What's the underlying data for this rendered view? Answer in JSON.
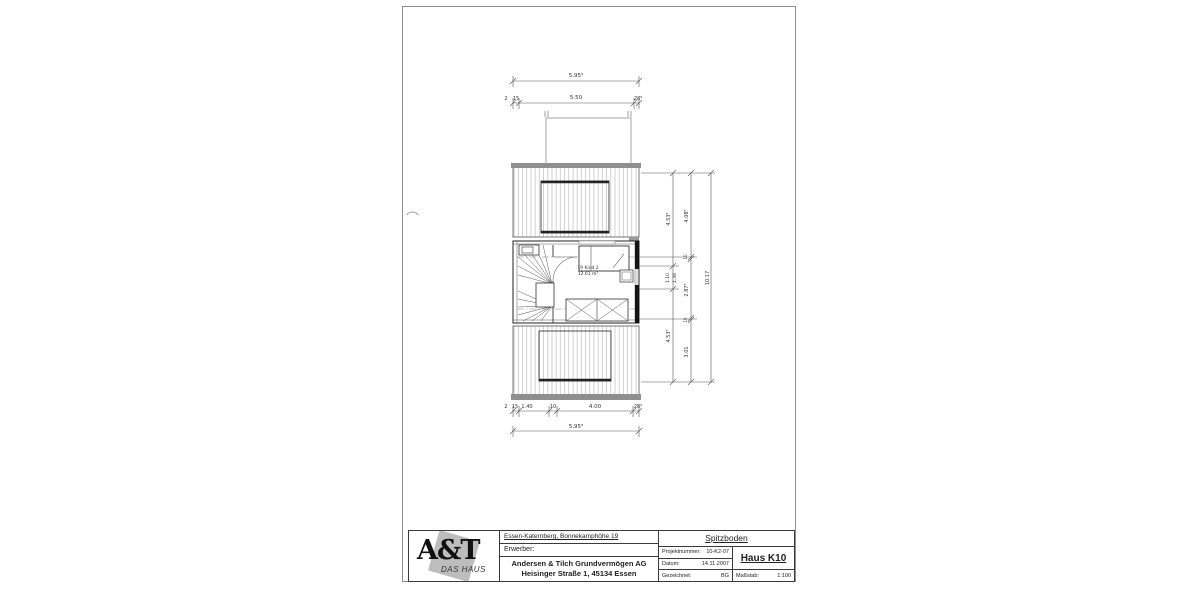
{
  "drawing": {
    "dims_top": {
      "total": "5.95⁵",
      "seg_a": "2",
      "seg_b": "15",
      "seg_mid": "5.50",
      "seg_right": "28⁵"
    },
    "dims_bottom": {
      "segs": [
        "2",
        "15",
        "1.40",
        "10",
        "4.00",
        "28⁵"
      ],
      "total": "5.95⁵"
    },
    "dims_right": {
      "inner_top": "4.53⁵",
      "inner_mid_a": "1.10",
      "inner_mid_b": "1.38",
      "inner_bottom": "4.53⁵",
      "mid_top": "4.08⁵",
      "mid_s1": "10",
      "mid_center": "2.87⁵",
      "mid_s2": "10",
      "mid_bottom": "3.01",
      "total": "10.17"
    },
    "room": {
      "label": "19 Kind 2",
      "area": "12.61 m²"
    }
  },
  "titleblock": {
    "logo": {
      "main": "A&T",
      "sub": "DAS HAUS"
    },
    "address": "Essen-Katernberg, Bonnekamphöhe 19",
    "erwerber_label": "Erwerber:",
    "company_line1": "Andersen & Tilch Grundvermögen AG",
    "company_line2": "Heisinger Straße 1, 45134 Essen",
    "plan_title": "Spitzboden",
    "fields": {
      "projekt_label": "Projektnummer:",
      "projekt_value": "10-K2-07",
      "datum_label": "Datum:",
      "datum_value": "14.11.2007",
      "gezeichnet_label": "Gezeichnet:",
      "gezeichnet_value": "BG",
      "haus": "Haus K10",
      "massstab_label": "Maßstab:",
      "massstab_value": "1:100"
    }
  }
}
